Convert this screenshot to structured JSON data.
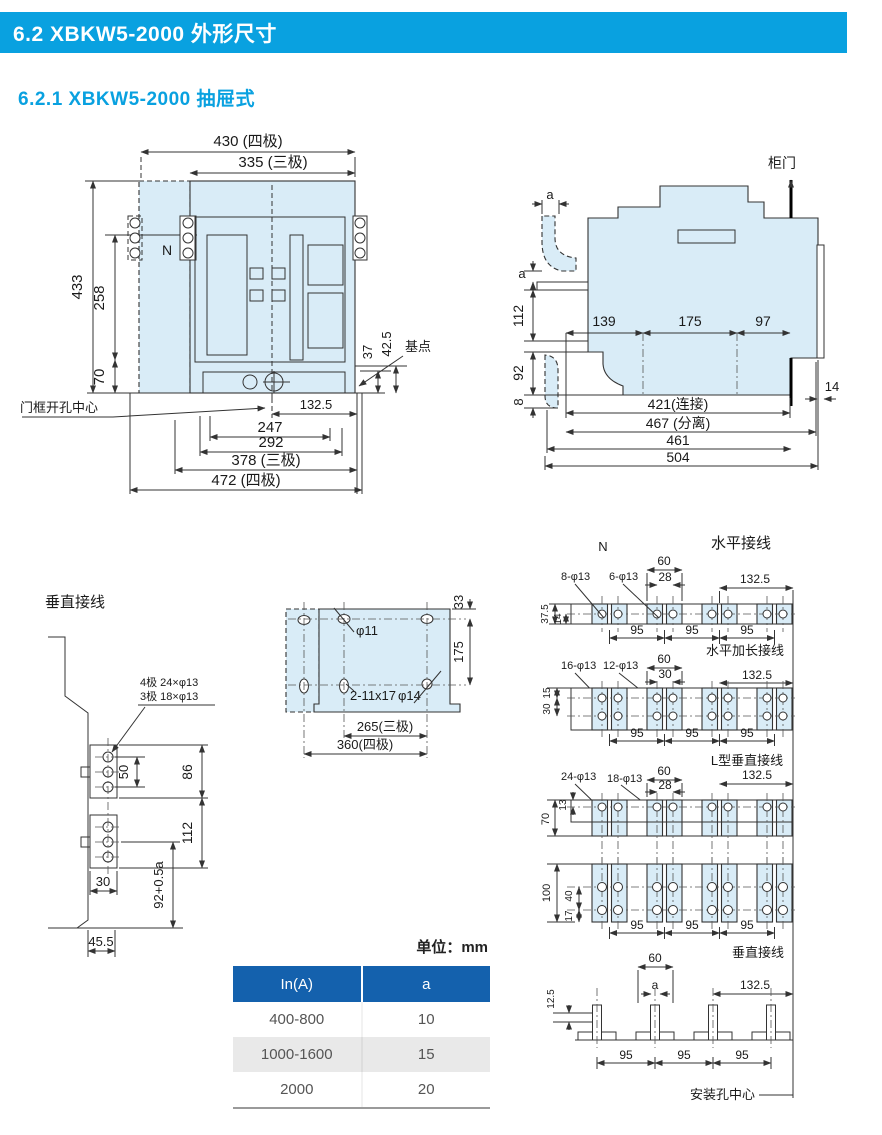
{
  "header": {
    "section": "6.2 XBKW5-2000 外形尺寸",
    "subsection": "6.2.1 XBKW5-2000 抽屉式"
  },
  "colors": {
    "accent_blue": "#09a1e0",
    "table_header_blue": "#1461ad",
    "drawing_fill": "#d9ecf7"
  },
  "front_view": {
    "w4p": "430 (四极)",
    "w3p": "335 (三极)",
    "h433": "433",
    "h258": "258",
    "h70": "70",
    "n_label": "N",
    "d37": "37",
    "d42_5": "42.5",
    "base_point": "基点",
    "door_center": "门框开孔中心",
    "d132_5": "132.5",
    "d247": "247",
    "d292": "292",
    "w3p_b": "378 (三极)",
    "w4p_b": "472 (四极)"
  },
  "side_view": {
    "door": "柜门",
    "a": "a",
    "d112": "112",
    "d92": "92",
    "d8": "8",
    "d139": "139",
    "d175": "175",
    "d97": "97",
    "d421": "421(连接)",
    "d467": "467 (分离)",
    "d461": "461",
    "d504": "504",
    "d14": "14"
  },
  "vertical_wiring": {
    "title": "垂直接线",
    "holes_4p": "4极 24×φ13",
    "holes_3p": "3极 18×φ13",
    "d50": "50",
    "d86": "86",
    "d112": "112",
    "d30": "30",
    "d92a": "92+0.5a",
    "d45_5": "45.5"
  },
  "mounting_plate": {
    "phi11": "φ11",
    "slots": "2-11x17",
    "phi14": "φ14",
    "d33": "33",
    "d175": "175",
    "d265": "265(三极)",
    "d360": "360(四极)"
  },
  "right_panel": {
    "n_label": "N",
    "d95": "95",
    "d132_5": "132.5",
    "horizontal": {
      "label": "水平接线",
      "holes_4p": "8-φ13",
      "holes_3p": "6-φ13",
      "d60": "60",
      "d28": "28",
      "d37_5": "37.5",
      "d14": "14"
    },
    "horizontal_ext": {
      "label": "水平加长接线",
      "holes_4p": "16-φ13",
      "holes_3p": "12-φ13",
      "d60": "60",
      "d30": "30",
      "d15": "15",
      "d30b": "30"
    },
    "l_vertical": {
      "label": "L型垂直接线",
      "holes_4p": "24-φ13",
      "holes_3p": "18-φ13",
      "d60": "60",
      "d28": "28",
      "d70": "70",
      "d13": "13"
    },
    "vertical_face": {
      "d100": "100",
      "d40": "40",
      "d17": "17"
    },
    "vertical": {
      "label": "垂直接线",
      "d60": "60",
      "a": "a",
      "d12_5": "12.5",
      "mount_center": "安装孔中心"
    }
  },
  "units_note": "单位：mm",
  "table": {
    "col1": "In(A)",
    "col2": "a",
    "rows": [
      [
        "400-800",
        "10"
      ],
      [
        "1000-1600",
        "15"
      ],
      [
        "2000",
        "20"
      ]
    ]
  }
}
